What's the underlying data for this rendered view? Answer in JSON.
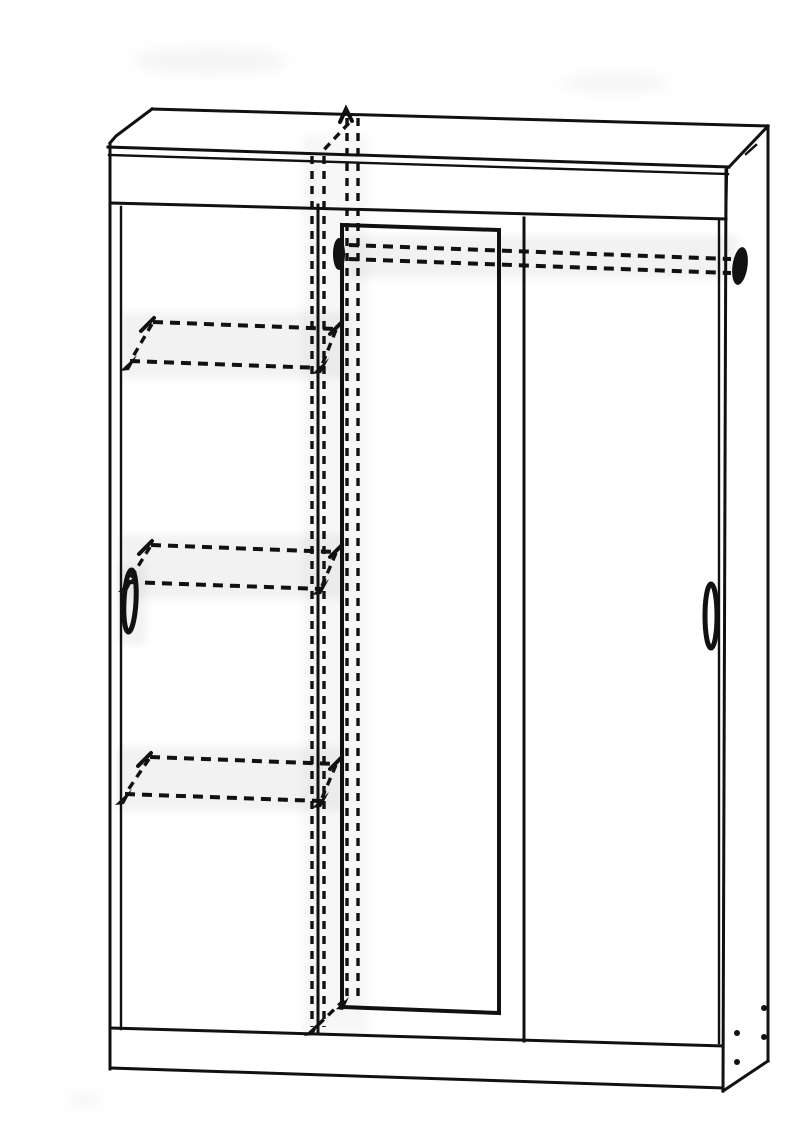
{
  "page": {
    "title": "Wardrobe line drawing",
    "background": "#ffffff"
  },
  "diagram": {
    "description": "Perspective line drawing of a three-door sliding wardrobe: left plain door with oval handle, centre door with tall mirror, right plain door with oval handle; hidden interior divider, clothes rail with two end brackets and three shelves shown with dashed lines; crown top panel, plinth and right side panel with four fixing dowels.",
    "ink": "#111111",
    "paper": "#ffffff",
    "counts": {
      "doors": 3,
      "hidden_shelves": 3,
      "rail_brackets": 2,
      "fixing_dowels": 4,
      "handles": 2
    },
    "parts": [
      {
        "name": "top-panel"
      },
      {
        "name": "crown-fascia"
      },
      {
        "name": "left-side-edge"
      },
      {
        "name": "right-side-panel"
      },
      {
        "name": "left-sliding-door"
      },
      {
        "name": "mirror-door"
      },
      {
        "name": "mirror"
      },
      {
        "name": "right-sliding-door"
      },
      {
        "name": "left-door-handle"
      },
      {
        "name": "right-door-handle"
      },
      {
        "name": "hidden-divider"
      },
      {
        "name": "clothes-rail"
      },
      {
        "name": "rail-bracket-left"
      },
      {
        "name": "rail-bracket-right"
      },
      {
        "name": "hidden-shelf-1"
      },
      {
        "name": "hidden-shelf-2"
      },
      {
        "name": "hidden-shelf-3"
      },
      {
        "name": "plinth"
      },
      {
        "name": "fixing-dowels"
      }
    ]
  }
}
